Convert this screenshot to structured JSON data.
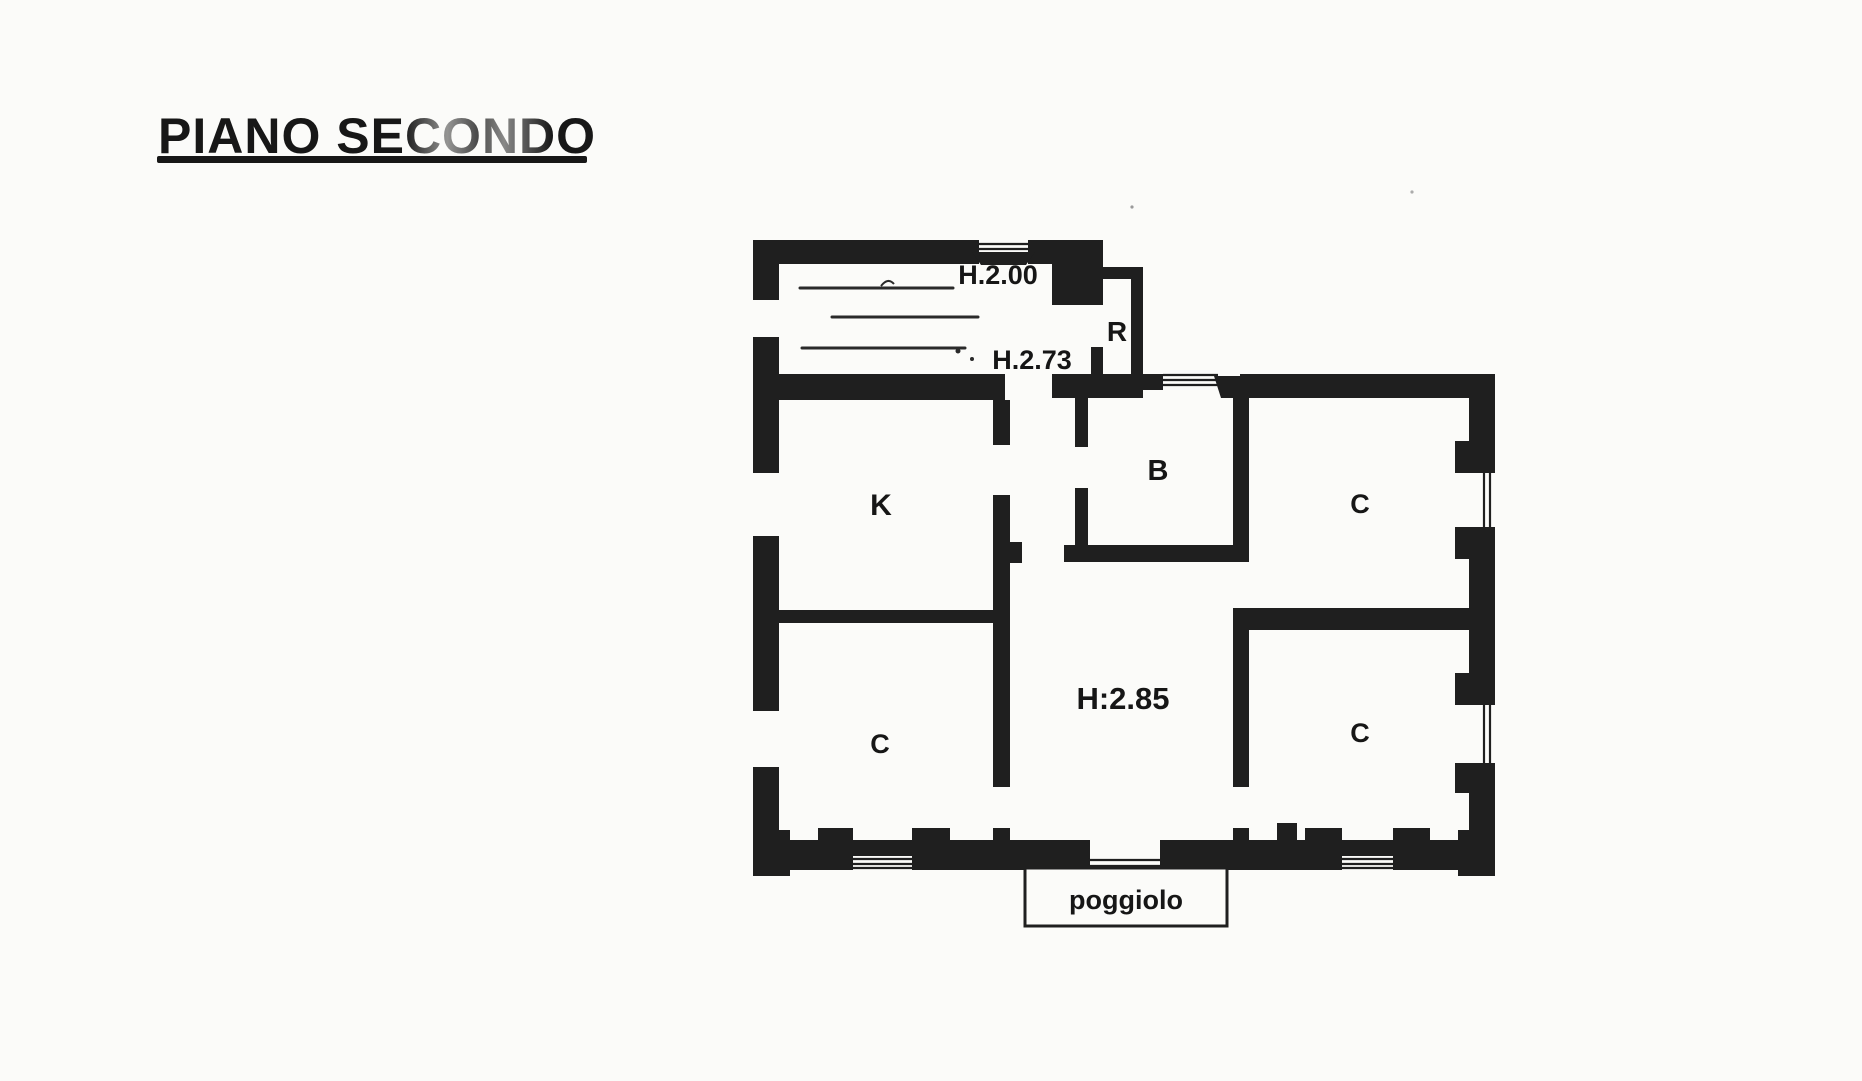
{
  "title": "PIANO SECONDO",
  "colors": {
    "ink": "#1f1f1f",
    "paper": "#fbfbf9"
  },
  "floor_plan": {
    "attic": {
      "height_front": "H.2.00",
      "height_back": "H.2.73"
    },
    "rooms": {
      "storage": "R",
      "kitchen": "K",
      "bathroom": "B",
      "room_top_right": "C",
      "room_bottom_left": "C",
      "room_bottom_right": "C"
    },
    "hall": {
      "height": "H:2.85"
    },
    "balcony": {
      "label": "poggiolo"
    }
  }
}
